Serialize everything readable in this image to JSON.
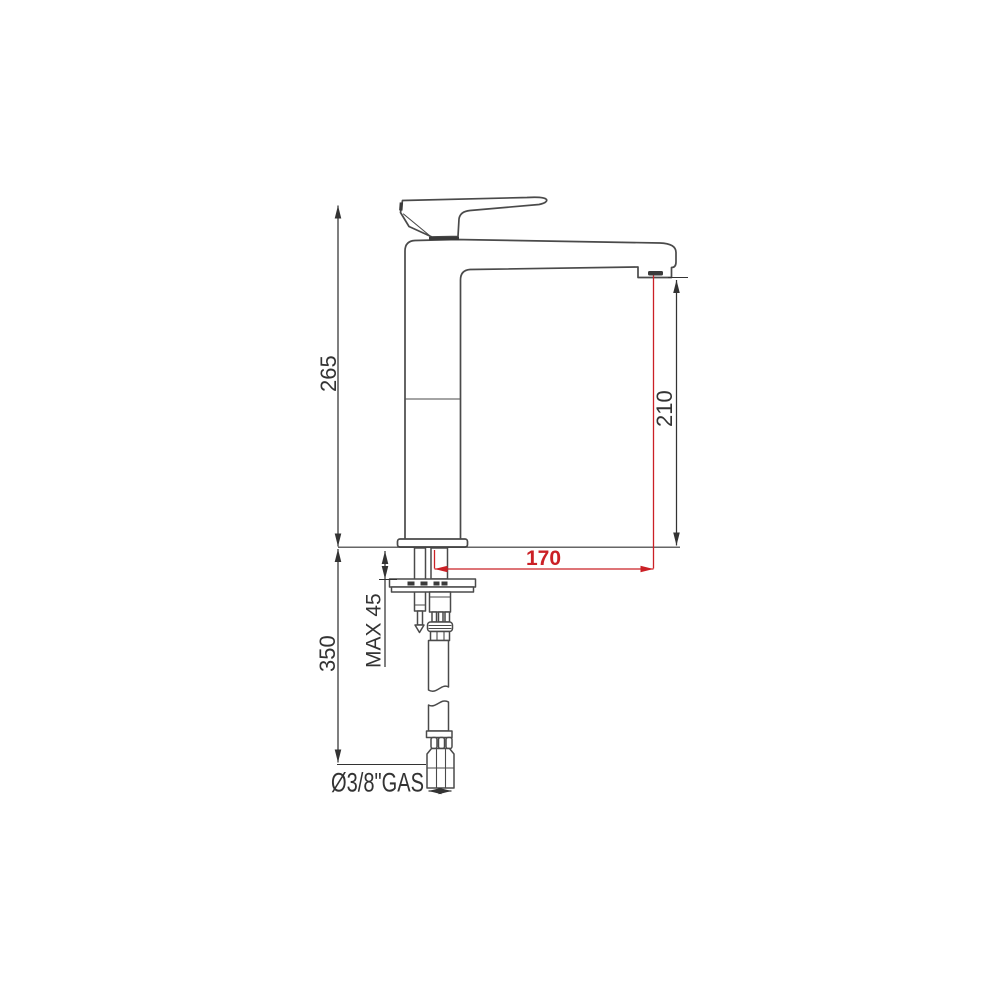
{
  "colors": {
    "line": "#4a4a4a",
    "dim": "#333333",
    "red": "#cb2026"
  },
  "drawing": {
    "type": "faucet-dimension-drawing",
    "labels": {
      "total_height": "265",
      "under_counter_length": "350",
      "max_deck_thickness": "MAX 45",
      "spout_reach": "170",
      "spout_outlet_height": "210",
      "connection_size": "Ø3/8\"GAS"
    }
  }
}
